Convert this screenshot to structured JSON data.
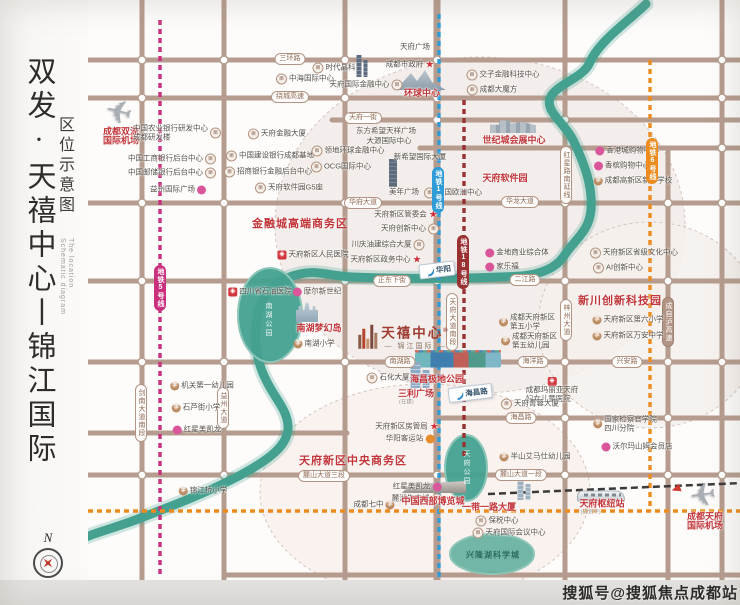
{
  "sidebar": {
    "title_main": "双发·天禧中心丨锦江国际",
    "title_sub": "区位示意图",
    "title_en_1": "The location",
    "title_en_2": "Schematic diagram"
  },
  "watermark": "搜狐号@搜狐焦点成都站",
  "compass_n": "N",
  "colors": {
    "road": "#b59c8e",
    "river": "#44a190",
    "metro1": "#2f9cd8",
    "metro5": "#c9317e",
    "metro18": "#993032",
    "metro6": "#ec8c1e",
    "rail": "#3a3a3a",
    "red": "#c2363b"
  },
  "map": {
    "circles": [
      {
        "cx": 480,
        "cy": 225,
        "rx": 205,
        "ry": 168,
        "fill": "#f1ebe7"
      },
      {
        "cx": 650,
        "cy": 325,
        "rx": 112,
        "ry": 103,
        "fill": "#f5f0ec"
      },
      {
        "cx": 425,
        "cy": 492,
        "rx": 165,
        "ry": 108,
        "fill": "#f8f0ec"
      }
    ],
    "roads_h": [
      {
        "y": 60,
        "x1": 88,
        "x2": 740
      },
      {
        "y": 98,
        "x1": 88,
        "x2": 740
      },
      {
        "y": 120,
        "x1": 332,
        "x2": 740
      },
      {
        "y": 148,
        "x1": 420,
        "x2": 740
      },
      {
        "y": 203,
        "x1": 88,
        "x2": 740
      },
      {
        "y": 281,
        "x1": 88,
        "x2": 740
      },
      {
        "y": 362,
        "x1": 88,
        "x2": 740
      },
      {
        "y": 418,
        "x1": 437,
        "x2": 740
      },
      {
        "y": 433,
        "x1": 88,
        "x2": 347
      },
      {
        "y": 475,
        "x1": 88,
        "x2": 740
      },
      {
        "y": 575,
        "x1": 224,
        "x2": 740
      }
    ],
    "roads_v": [
      {
        "x": 142,
        "y1": 0,
        "y2": 580
      },
      {
        "x": 224,
        "y1": 0,
        "y2": 580
      },
      {
        "x": 345,
        "y1": 0,
        "y2": 580
      },
      {
        "x": 437,
        "y1": 0,
        "y2": 580,
        "w": 7
      },
      {
        "x": 565,
        "y1": 0,
        "y2": 580
      },
      {
        "x": 668,
        "y1": 148,
        "y2": 580
      },
      {
        "x": 722,
        "y1": 0,
        "y2": 580
      }
    ],
    "nodes": [
      [
        142,
        60
      ],
      [
        224,
        60
      ],
      [
        345,
        60
      ],
      [
        437,
        60
      ],
      [
        722,
        60
      ],
      [
        142,
        98
      ],
      [
        345,
        98
      ],
      [
        437,
        98
      ],
      [
        722,
        98
      ],
      [
        437,
        120
      ],
      [
        565,
        120
      ],
      [
        722,
        148
      ],
      [
        142,
        203
      ],
      [
        224,
        203
      ],
      [
        345,
        203
      ],
      [
        437,
        203
      ],
      [
        565,
        203
      ],
      [
        668,
        203
      ],
      [
        722,
        203
      ],
      [
        142,
        281
      ],
      [
        345,
        281
      ],
      [
        437,
        281
      ],
      [
        565,
        281
      ],
      [
        668,
        281
      ],
      [
        142,
        362
      ],
      [
        224,
        362
      ],
      [
        345,
        362
      ],
      [
        437,
        362
      ],
      [
        565,
        362
      ],
      [
        668,
        362
      ],
      [
        722,
        362
      ],
      [
        565,
        418
      ],
      [
        668,
        418
      ],
      [
        142,
        433
      ],
      [
        142,
        475
      ],
      [
        224,
        475
      ],
      [
        345,
        475
      ],
      [
        437,
        475
      ],
      [
        565,
        475
      ],
      [
        668,
        475
      ],
      [
        722,
        475
      ]
    ],
    "river": "M646,4 C630,20 600,40 590,62 C584,78 556,84 550,98 C545,112 566,124 574,142 C584,163 593,186 591,210 C589,232 574,240 564,256 C556,268 542,274 522,276 C470,279 400,279 352,277 C330,276 318,270 300,274 C276,279 261,294 257,318 C253,342 257,362 266,380 C275,399 287,409 288,426 C289,444 271,458 246,472 C214,490 172,506 138,519 C117,527 101,531 86,537",
    "parks": [
      {
        "name": "南湖公园",
        "cx": 270,
        "cy": 315,
        "rx": 32,
        "ry": 47,
        "lx": 268,
        "ly": 320,
        "dark": false
      },
      {
        "name": "天府公园",
        "cx": 466,
        "cy": 468,
        "rx": 21,
        "ry": 33,
        "lx": 466,
        "ly": 468,
        "dark": false
      },
      {
        "name": "兴隆湖科学城",
        "cx": 492,
        "cy": 554,
        "rx": 42,
        "ry": 20,
        "lx": 493,
        "ly": 555,
        "dark": true
      }
    ],
    "metro_lines": [
      {
        "name": "metro5",
        "x1": 160,
        "y1": 20,
        "x2": 160,
        "y2": 578
      },
      {
        "name": "metro1",
        "x1": 439,
        "y1": 14,
        "x2": 439,
        "y2": 580
      },
      {
        "name": "metro18",
        "x1": 464,
        "y1": 100,
        "x2": 464,
        "y2": 457
      },
      {
        "name": "metro6",
        "x1": 650,
        "y1": 60,
        "x2": 650,
        "y2": 511
      },
      {
        "name": "metro6",
        "x1": 88,
        "y1": 511,
        "x2": 740,
        "y2": 511
      }
    ],
    "rail": {
      "x1": 488,
      "y1": 494,
      "x2": 742,
      "y2": 483
    },
    "capsules_h": [
      {
        "t": "三环路",
        "x": 290,
        "y": 59
      },
      {
        "t": "绕城高速",
        "x": 290,
        "y": 97
      },
      {
        "t": "天府一街",
        "x": 363,
        "y": 118
      },
      {
        "t": "华府大道",
        "x": 363,
        "y": 203
      },
      {
        "t": "华龙大道",
        "x": 520,
        "y": 202
      },
      {
        "t": "正东下街",
        "x": 392,
        "y": 281
      },
      {
        "t": "二江路",
        "x": 525,
        "y": 280
      },
      {
        "t": "南湖路",
        "x": 400,
        "y": 362
      },
      {
        "t": "海洋路",
        "x": 533,
        "y": 362
      },
      {
        "t": "兴安路",
        "x": 627,
        "y": 362
      },
      {
        "t": "海昌路",
        "x": 521,
        "y": 418
      },
      {
        "t": "麓山大道三段",
        "x": 324,
        "y": 476
      },
      {
        "t": "麓山大道一段",
        "x": 521,
        "y": 475
      }
    ],
    "capsules_v": [
      {
        "t": "剑南大道南段",
        "x": 141,
        "y": 413
      },
      {
        "t": "益州大道",
        "x": 223,
        "y": 408
      },
      {
        "t": "天府大道南段",
        "x": 452,
        "y": 322
      },
      {
        "t": "红星路南延线",
        "x": 566,
        "y": 175
      },
      {
        "t": "梓州大道",
        "x": 566,
        "y": 320
      },
      {
        "t": "成自泸高速",
        "x": 668,
        "y": 322,
        "hw": true
      }
    ],
    "metro_caps": [
      {
        "t": "地铁5号线",
        "x": 160,
        "y": 288,
        "c": "#c9317e"
      },
      {
        "t": "地铁1号线",
        "x": 438,
        "y": 190,
        "c": "#2f9cd8"
      },
      {
        "t": "地铁18号线",
        "x": 463,
        "y": 262,
        "c": "#993032"
      },
      {
        "t": "地铁6号线",
        "x": 652,
        "y": 161,
        "c": "#ec8c1e"
      }
    ],
    "signs": [
      {
        "t": "华阳",
        "x": 437,
        "y": 270
      },
      {
        "t": "海昌路",
        "x": 470,
        "y": 393
      }
    ],
    "zones": [
      {
        "t": "金融城高端商务区",
        "x": 300,
        "y": 223
      },
      {
        "t": "新川创新科技园",
        "x": 620,
        "y": 300
      },
      {
        "t": "天府新区中央商务区",
        "x": 353,
        "y": 460
      }
    ],
    "project": {
      "name": "天禧中心",
      "sub": "— 锦江国际 —",
      "x": 404,
      "y": 337
    },
    "pois": [
      {
        "t": [
          "天府广场"
        ],
        "x": 415,
        "y": 47,
        "i": "none",
        "k": "n"
      },
      {
        "t": [
          "成都市政府"
        ],
        "x": 410,
        "y": 65,
        "i": "star",
        "s": "r",
        "k": "n"
      },
      {
        "t": [
          "时代晶科"
        ],
        "x": 334,
        "y": 68,
        "i": "bldg",
        "s": "l",
        "k": "n"
      },
      {
        "t": [
          "中海国际中心"
        ],
        "x": 305,
        "y": 79,
        "i": "bldg",
        "s": "l",
        "k": "n"
      },
      {
        "t": [
          "天府国际金融中心"
        ],
        "x": 366,
        "y": 85,
        "i": "bldg",
        "s": "r",
        "k": "n"
      },
      {
        "t": [
          "环球中心"
        ],
        "x": 422,
        "y": 93,
        "i": "none",
        "k": "r",
        "fs": 9
      },
      {
        "t": [
          "交子金融科技中心"
        ],
        "x": 503,
        "y": 75,
        "i": "bldg",
        "s": "l",
        "k": "n"
      },
      {
        "t": [
          "成都大魔方"
        ],
        "x": 492,
        "y": 90,
        "i": "bldg",
        "s": "l",
        "k": "n"
      },
      {
        "t": [
          "成都双流",
          "国际机场"
        ],
        "x": 121,
        "y": 136,
        "i": "none",
        "k": "r",
        "fs": 9
      },
      {
        "t": [
          "中国农业银行研发中心",
          "成都研发楼"
        ],
        "x": 177,
        "y": 133,
        "i": "bldg",
        "s": "r",
        "k": "n"
      },
      {
        "t": [
          "中国工商银行后台中心"
        ],
        "x": 172,
        "y": 159,
        "i": "bldg",
        "s": "r",
        "k": "n"
      },
      {
        "t": [
          "中国邮储银行后台中心"
        ],
        "x": 172,
        "y": 173,
        "i": "bldg",
        "s": "r",
        "k": "n"
      },
      {
        "t": [
          "益州国际广场"
        ],
        "x": 178,
        "y": 190,
        "i": "shop",
        "s": "r",
        "k": "n"
      },
      {
        "t": [
          "天府金融大厦"
        ],
        "x": 277,
        "y": 134,
        "i": "bldg",
        "s": "l",
        "k": "n"
      },
      {
        "t": [
          "中国建设银行成都基地"
        ],
        "x": 270,
        "y": 156,
        "i": "bldg",
        "s": "l",
        "k": "n"
      },
      {
        "t": [
          "招商银行金融后台中心"
        ],
        "x": 268,
        "y": 172,
        "i": "bldg",
        "s": "l",
        "k": "n"
      },
      {
        "t": [
          "东方希望天祥广场"
        ],
        "x": 386,
        "y": 131,
        "i": "none",
        "k": "n"
      },
      {
        "t": [
          "大源国际中心"
        ],
        "x": 389,
        "y": 141,
        "i": "none",
        "k": "n"
      },
      {
        "t": [
          "领地环球金融中心"
        ],
        "x": 348,
        "y": 151,
        "i": "bldg",
        "s": "l",
        "k": "n"
      },
      {
        "t": [
          "新希望国际大厦"
        ],
        "x": 420,
        "y": 157,
        "i": "none",
        "k": "n"
      },
      {
        "t": [
          "OCG国际中心"
        ],
        "x": 341,
        "y": 167,
        "i": "bldg",
        "s": "l",
        "k": "n"
      },
      {
        "t": [
          "天府软件园G5座"
        ],
        "x": 289,
        "y": 188,
        "i": "bldg",
        "s": "l",
        "k": "n"
      },
      {
        "t": [
          "世纪城会展中心"
        ],
        "x": 514,
        "y": 140,
        "i": "none",
        "k": "r",
        "fs": 9
      },
      {
        "t": [
          "天府软件园"
        ],
        "x": 505,
        "y": 178,
        "i": "none",
        "k": "r",
        "fs": 9
      },
      {
        "t": [
          "中国欧洲中心"
        ],
        "x": 453,
        "y": 193,
        "i": "bldg",
        "s": "l",
        "k": "n"
      },
      {
        "t": [
          "香港城购物中心"
        ],
        "x": 627,
        "y": 151,
        "i": "shop",
        "s": "l",
        "k": "n"
      },
      {
        "t": [
          "香槟购物中心"
        ],
        "x": 622,
        "y": 166,
        "i": "shop",
        "s": "l",
        "k": "n"
      },
      {
        "t": [
          "成都高新区新华学校"
        ],
        "x": 633,
        "y": 181,
        "i": "school",
        "s": "l",
        "k": "n"
      },
      {
        "t": [
          "美年广场"
        ],
        "x": 404,
        "y": 192,
        "i": "none",
        "k": "n"
      },
      {
        "t": [
          "天府新区管委会"
        ],
        "x": 406,
        "y": 215,
        "i": "star",
        "s": "r",
        "k": "n"
      },
      {
        "t": [
          "天府创新中心"
        ],
        "x": 410,
        "y": 229,
        "i": "bldg",
        "s": "r",
        "k": "n"
      },
      {
        "t": [
          "川庆油建综合大厦"
        ],
        "x": 388,
        "y": 245,
        "i": "bldg",
        "s": "r",
        "k": "n"
      },
      {
        "t": [
          "天府新区政务中心"
        ],
        "x": 386,
        "y": 260,
        "i": "star",
        "s": "r",
        "k": "n"
      },
      {
        "t": [
          "金地商业综合体"
        ],
        "x": 517,
        "y": 253,
        "i": "shop",
        "s": "l",
        "k": "n"
      },
      {
        "t": [
          "家乐福"
        ],
        "x": 502,
        "y": 267,
        "i": "shop",
        "s": "l",
        "k": "n"
      },
      {
        "t": [
          "天府新区省级文化中心"
        ],
        "x": 634,
        "y": 253,
        "i": "bldg",
        "s": "l",
        "k": "n"
      },
      {
        "t": [
          "AI创新中心"
        ],
        "x": 618,
        "y": 268,
        "i": "bldg",
        "s": "l",
        "k": "n"
      },
      {
        "t": [
          "天府新区第六小学"
        ],
        "x": 628,
        "y": 320,
        "i": "school",
        "s": "l",
        "k": "n"
      },
      {
        "t": [
          "天府新区万安中学"
        ],
        "x": 628,
        "y": 336,
        "i": "school",
        "s": "l",
        "k": "n"
      },
      {
        "t": [
          "天府新区人民医院"
        ],
        "x": 313,
        "y": 255,
        "i": "hosp",
        "s": "l",
        "k": "n"
      },
      {
        "t": [
          "四川省石油医院"
        ],
        "x": 260,
        "y": 292,
        "i": "hosp",
        "s": "l",
        "k": "n"
      },
      {
        "t": [
          "摩尔新世纪"
        ],
        "x": 317,
        "y": 292,
        "i": "shop",
        "s": "l",
        "k": "n"
      },
      {
        "t": [
          "南湖梦幻岛"
        ],
        "x": 319,
        "y": 328,
        "i": "none",
        "k": "r",
        "fs": 9
      },
      {
        "t": [
          "南湖小学"
        ],
        "x": 314,
        "y": 344,
        "i": "school",
        "s": "l",
        "k": "n"
      },
      {
        "t": [
          "机关第一幼儿园"
        ],
        "x": 202,
        "y": 386,
        "i": "school",
        "s": "l",
        "k": "n"
      },
      {
        "t": [
          "石芦街小学"
        ],
        "x": 196,
        "y": 408,
        "i": "school",
        "s": "l",
        "k": "n"
      },
      {
        "t": [
          "红星美凯龙"
        ],
        "x": 197,
        "y": 430,
        "i": "shop",
        "s": "l",
        "k": "n"
      },
      {
        "t": [
          "锦江桥小学"
        ],
        "x": 203,
        "y": 491,
        "i": "school",
        "s": "l",
        "k": "n"
      },
      {
        "t": [
          "石化大厦"
        ],
        "x": 388,
        "y": 378,
        "i": "bldg",
        "s": "l",
        "k": "n"
      },
      {
        "t": [
          "三利广场"
        ],
        "x": 416,
        "y": 398,
        "i": "none",
        "k": "r",
        "fs": 9,
        "sx": "(在建)"
      },
      {
        "t": [
          "成都天府新区",
          "第五小学"
        ],
        "x": 527,
        "y": 322,
        "i": "school",
        "s": "l",
        "k": "n"
      },
      {
        "t": [
          "成都天府新区",
          "第五幼儿园"
        ],
        "x": 529,
        "y": 341,
        "i": "school",
        "s": "l",
        "k": "n"
      },
      {
        "t": [
          "海昌极地公园"
        ],
        "x": 437,
        "y": 379,
        "i": "none",
        "k": "r",
        "fs": 9
      },
      {
        "t": [
          "成都玛丽亚天府",
          "妇女儿童医院"
        ],
        "x": 552,
        "y": 390,
        "i": "hosp",
        "s": "t",
        "k": "n"
      },
      {
        "t": [
          "天府菁蓉大厦"
        ],
        "x": 530,
        "y": 404,
        "i": "bldg",
        "s": "l",
        "k": "n"
      },
      {
        "t": [
          "天府新区房管局"
        ],
        "x": 407,
        "y": 427,
        "i": "star",
        "s": "r",
        "k": "n"
      },
      {
        "t": [
          "华阳客运站"
        ],
        "x": 410,
        "y": 439,
        "i": "bus",
        "s": "r",
        "k": "n"
      },
      {
        "t": [
          "半山艾马仕幼儿园"
        ],
        "x": 535,
        "y": 457,
        "i": "school",
        "s": "l",
        "k": "n"
      },
      {
        "t": [
          "红星美凯龙"
        ],
        "x": 417,
        "y": 487,
        "i": "shop",
        "s": "r",
        "k": "n"
      },
      {
        "t": [
          "麓湖生态城"
        ],
        "x": 417,
        "y": 499,
        "i": "bldg",
        "s": "r",
        "k": "n"
      },
      {
        "t": [
          "成都七中"
        ],
        "x": 374,
        "y": 505,
        "i": "school",
        "s": "r",
        "k": "n"
      },
      {
        "t": [
          "中国西部博览城"
        ],
        "x": 433,
        "y": 501,
        "i": "none",
        "k": "r",
        "fs": 9
      },
      {
        "t": [
          "一带一路大厦"
        ],
        "x": 489,
        "y": 507,
        "i": "none",
        "k": "r",
        "fs": 9
      },
      {
        "t": [
          "保税中心"
        ],
        "x": 497,
        "y": 521,
        "i": "bldg",
        "s": "l",
        "k": "n"
      },
      {
        "t": [
          "天府国际会议中心"
        ],
        "x": 509,
        "y": 533,
        "i": "bldg",
        "s": "l",
        "k": "n"
      },
      {
        "t": [
          "国家检察官学院",
          "四川分院"
        ],
        "x": 625,
        "y": 424,
        "i": "school",
        "s": "l",
        "k": "n"
      },
      {
        "t": [
          "沃尔玛山姆会员店"
        ],
        "x": 637,
        "y": 447,
        "i": "shop",
        "s": "l",
        "k": "n"
      },
      {
        "t": [
          "天府枢纽站"
        ],
        "x": 602,
        "y": 508,
        "i": "none",
        "k": "r",
        "fs": 9,
        "sx": "(规划中)"
      },
      {
        "t": [
          "成都天府",
          "国际机场"
        ],
        "x": 705,
        "y": 521,
        "i": "none",
        "k": "r",
        "fs": 9
      }
    ],
    "arts": [
      {
        "kind": "towers",
        "x": 362,
        "y": 66
      },
      {
        "kind": "mountain",
        "x": 421,
        "y": 80
      },
      {
        "kind": "cluster",
        "x": 513,
        "y": 126
      },
      {
        "kind": "plane",
        "x": 119,
        "y": 112,
        "rot": 14,
        "flip": true
      },
      {
        "kind": "plane",
        "x": 703,
        "y": 495,
        "rot": -8,
        "flip": true
      },
      {
        "kind": "arrow",
        "x": 676,
        "y": 489,
        "rot": -20
      },
      {
        "kind": "train",
        "x": 601,
        "y": 496
      },
      {
        "kind": "castle",
        "x": 307,
        "y": 311
      },
      {
        "kind": "aquarium",
        "x": 458,
        "y": 360
      },
      {
        "kind": "expo",
        "x": 434,
        "y": 487
      },
      {
        "kind": "towers2",
        "x": 524,
        "y": 489
      },
      {
        "kind": "tower",
        "x": 393,
        "y": 173
      },
      {
        "kind": "towersblue",
        "x": 420,
        "y": 375
      }
    ]
  }
}
